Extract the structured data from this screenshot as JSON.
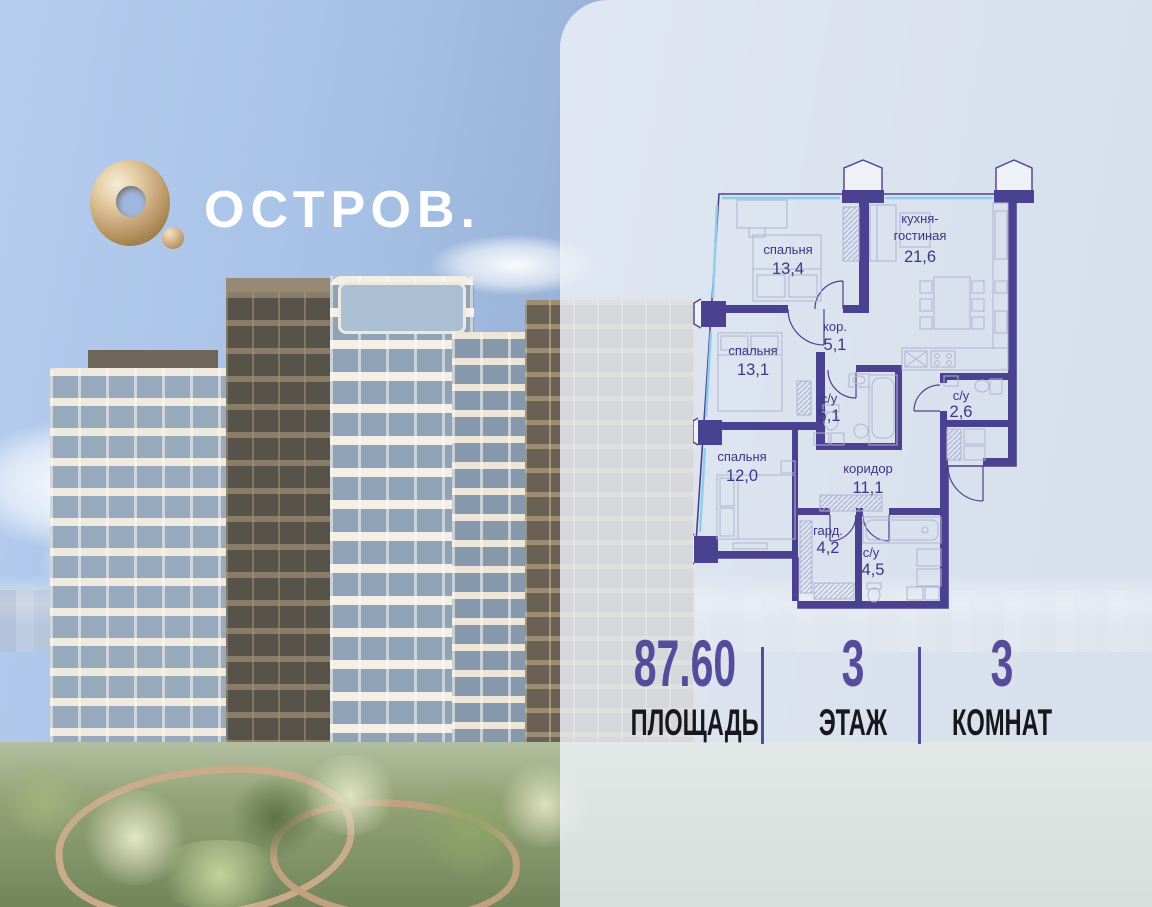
{
  "brand": {
    "name": "ОСТРОВ."
  },
  "plan": {
    "rooms": [
      {
        "line1": "спальня",
        "area": "13,4"
      },
      {
        "line1": "кухня-",
        "line2": "гостиная",
        "area": "21,6"
      },
      {
        "line1": "кор.",
        "area": "5,1"
      },
      {
        "line1": "спальня",
        "area": "13,1"
      },
      {
        "line1": "с/у",
        "area": "5,1"
      },
      {
        "line1": "с/у",
        "area": "2,6"
      },
      {
        "line1": "спальня",
        "area": "12,0"
      },
      {
        "line1": "коридор",
        "area": "11,1"
      },
      {
        "line1": "гард.",
        "area": "4,2"
      },
      {
        "line1": "с/у",
        "area": "4,5"
      }
    ]
  },
  "stats": {
    "items": [
      {
        "value": "87.60",
        "label": "ПЛОЩАДЬ"
      },
      {
        "value": "3",
        "label": "ЭТАЖ"
      },
      {
        "value": "3",
        "label": "КОМНАТ"
      }
    ]
  },
  "colors": {
    "wall": "#4b4191",
    "accent": "#574b9b",
    "label": "#3d3685",
    "glazing": "#8ccfec",
    "gold": "#c9a87a",
    "panel": "rgba(238,241,248,0.82)"
  }
}
